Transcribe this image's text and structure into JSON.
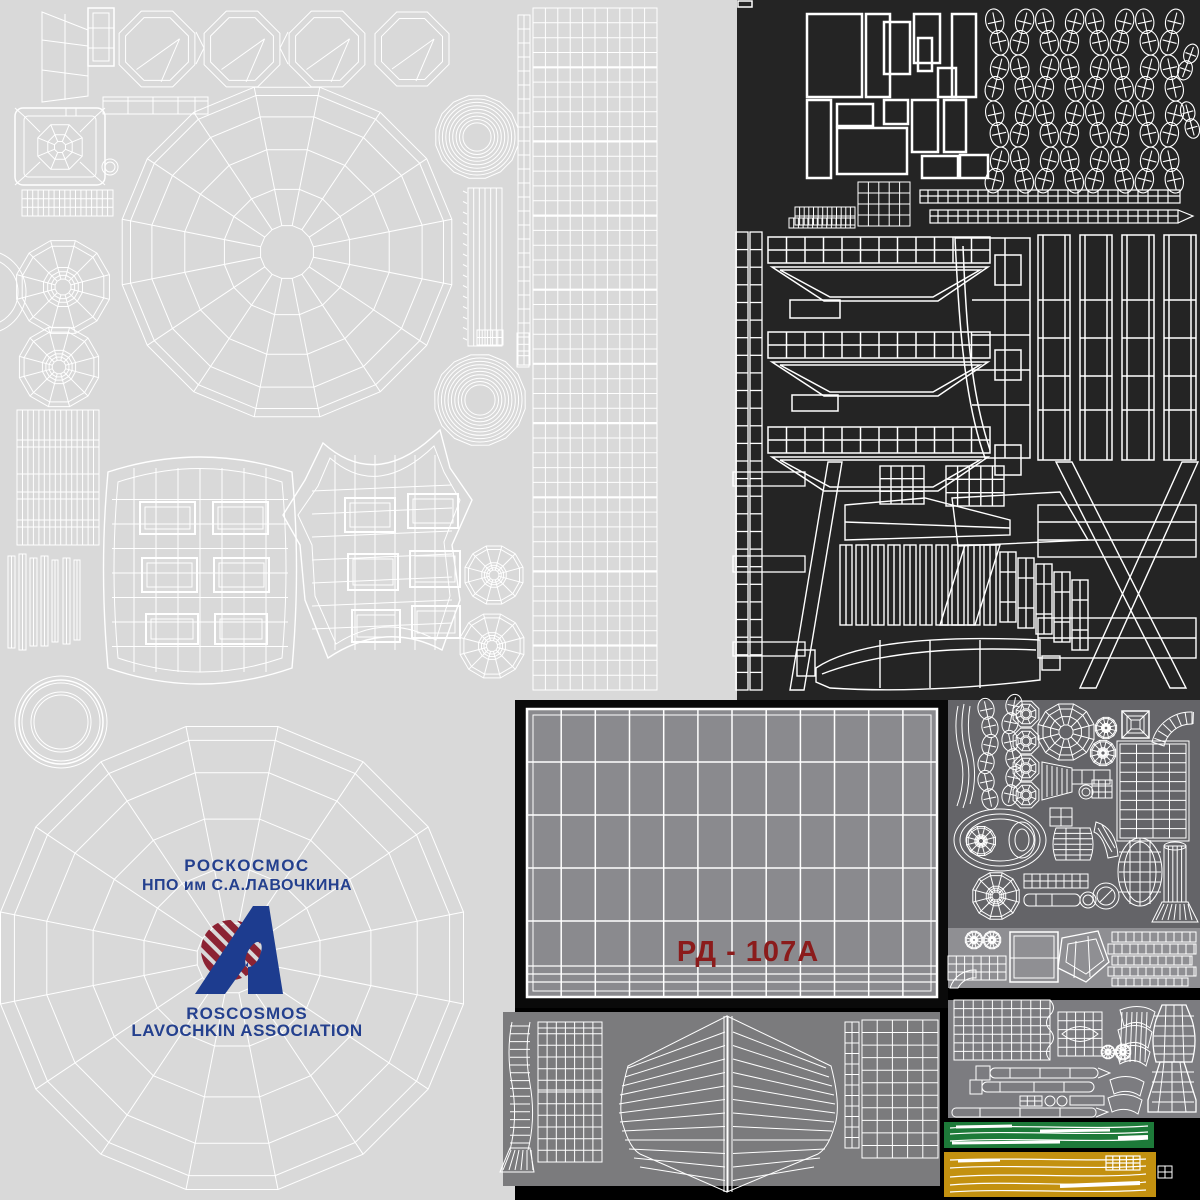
{
  "branding": {
    "org_ru": "РОСКОСМОС",
    "org_sub_ru": "НПО им С.А.ЛАВОЧКИНА",
    "org_en": "ROSCOSMOS",
    "org_sub_en": "LAVOCHKIN ASSOCIATION"
  },
  "engine_marking": {
    "label": "РД - 107А"
  },
  "palette": {
    "canvas_light": "#d9d9d9",
    "panel_dark": "#242424",
    "panel_engine_gray": "#8a8a8e",
    "panel_parts_gray": "#646468",
    "panel_parts_light_strip": "#8f8f93",
    "panel_lower_right_gray": "#7c7c80",
    "panel_lower_middle_gray": "#7b7b7d",
    "stripe_green": "#1d7a39",
    "stripe_yellow": "#c39110",
    "wireframe": "#ffffff",
    "text_blue": "#24408e",
    "text_red": "#8b1b1b",
    "logo_maroon": "#8c2333",
    "logo_blue": "#1d3c8f"
  }
}
